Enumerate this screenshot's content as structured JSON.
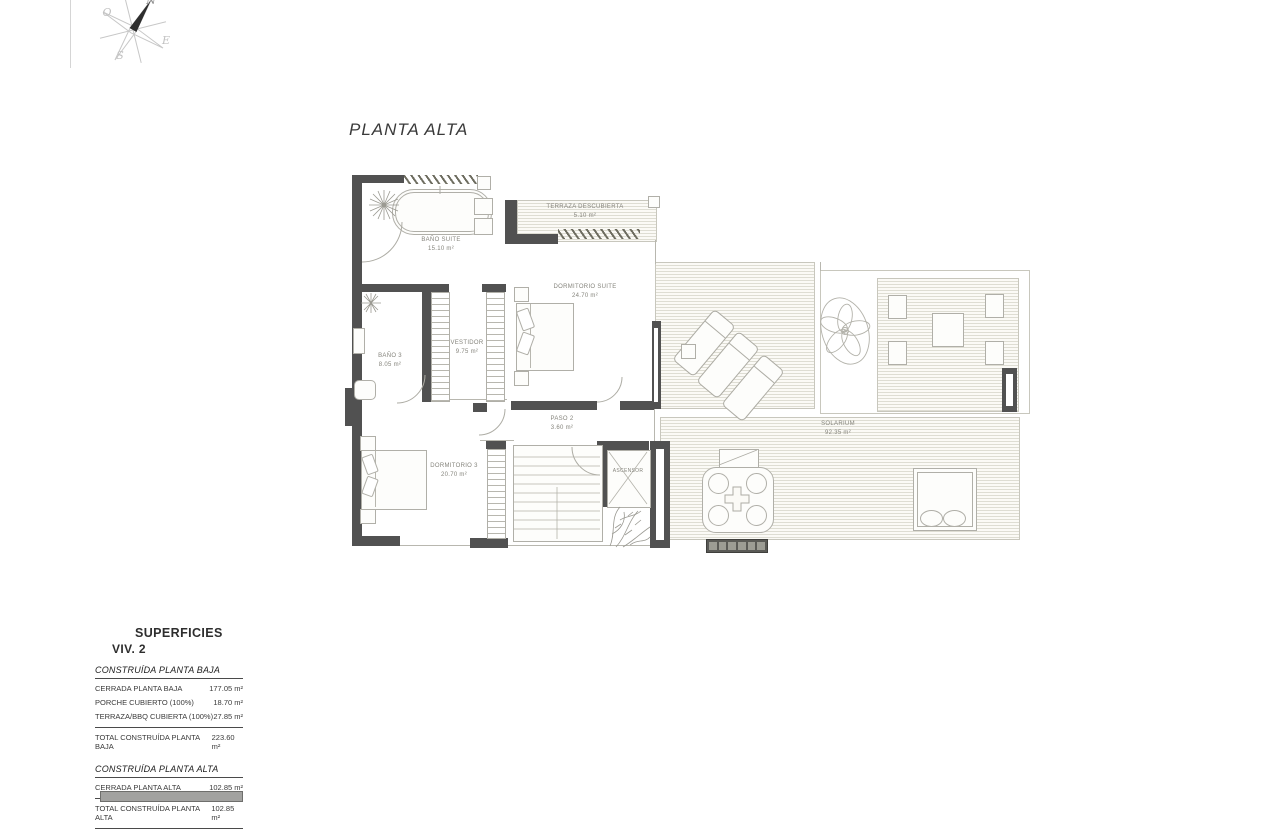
{
  "title": "PLANTA ALTA",
  "compass": {
    "n": "N",
    "o": "O",
    "s": "S",
    "e": "E"
  },
  "rooms": [
    {
      "name": "BAÑO SUITE",
      "area": "15.10 m²"
    },
    {
      "name": "TERRAZA DESCUBIERTA",
      "area": "5.10 m²"
    },
    {
      "name": "DORMITORIO SUITE",
      "area": "24.70 m²"
    },
    {
      "name": "VESTIDOR",
      "area": "9.75 m²"
    },
    {
      "name": "BAÑO 3",
      "area": "8.05 m²"
    },
    {
      "name": "PASO 2",
      "area": "3.60 m²"
    },
    {
      "name": "DORMITORIO 3",
      "area": "20.70 m²"
    },
    {
      "name": "ASCENSOR",
      "area": ""
    },
    {
      "name": "SOLARIUM",
      "area": "92.35 m²"
    }
  ],
  "surfaces": {
    "title": "SUPERFICIES",
    "subtitle": "VIV. 2",
    "sections": [
      {
        "header": "CONSTRUÍDA PLANTA BAJA",
        "rows": [
          {
            "label": "CERRADA PLANTA BAJA",
            "value": "177.05 m²"
          },
          {
            "label": "PORCHE CUBIERTO (100%)",
            "value": "18.70 m²"
          },
          {
            "label": "TERRAZA/BBQ CUBIERTA (100%)",
            "value": "27.85 m²"
          }
        ],
        "total_label": "TOTAL CONSTRUÍDA PLANTA BAJA",
        "total_value": "223.60 m²"
      },
      {
        "header": "CONSTRUÍDA PLANTA ALTA",
        "rows": [
          {
            "label": "CERRADA PLANTA ALTA",
            "value": "102.85 m²"
          }
        ],
        "total_label": "TOTAL CONSTRUÍDA PLANTA ALTA",
        "total_value": "102.85 m²"
      }
    ]
  },
  "colors": {
    "wall": "#515151",
    "drawing_line": "#b0afa8",
    "deck_stripe": "#deddd3",
    "bar": "#a2a2a0"
  }
}
